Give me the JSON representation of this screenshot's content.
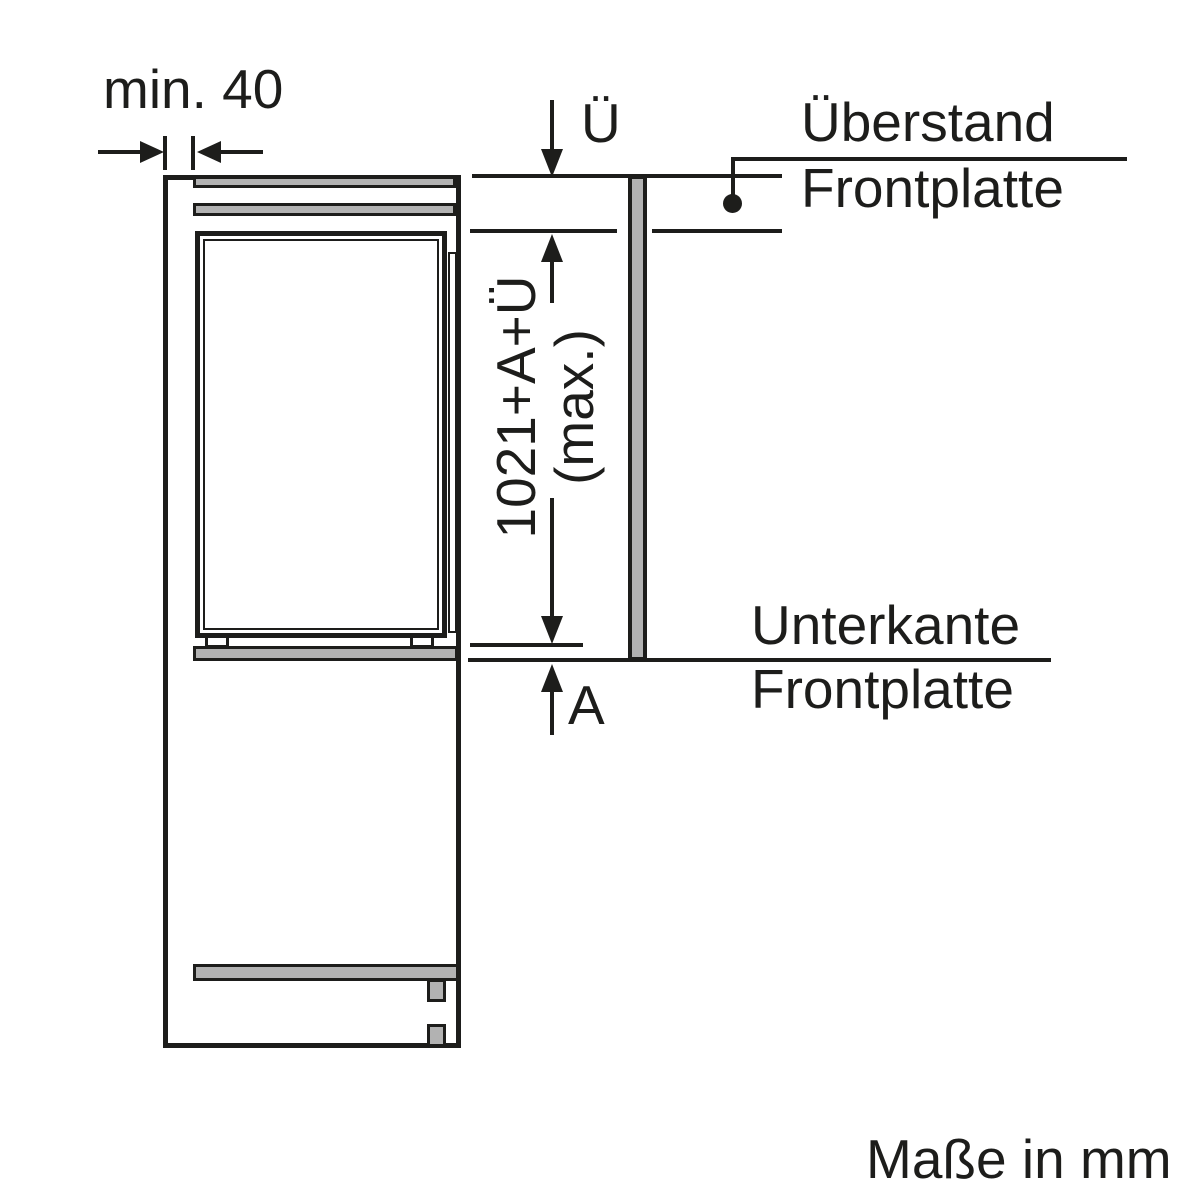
{
  "diagram": {
    "min_clearance_label": "min. 40",
    "overhang_symbol": "Ü",
    "max_height_label_line1": "1021+A+Ü",
    "max_height_label_line2": "(max.)",
    "adjustment_symbol": "A",
    "overhang_callout": {
      "line1": "Überstand",
      "line2": "Frontplatte"
    },
    "bottom_edge_callout": {
      "line1": "Unterkante",
      "line2": "Frontplatte"
    },
    "units_note": "Maße in mm"
  },
  "colors": {
    "line": "#1d1d1b",
    "panel_fill": "#b2b2b2",
    "background": "#ffffff"
  }
}
